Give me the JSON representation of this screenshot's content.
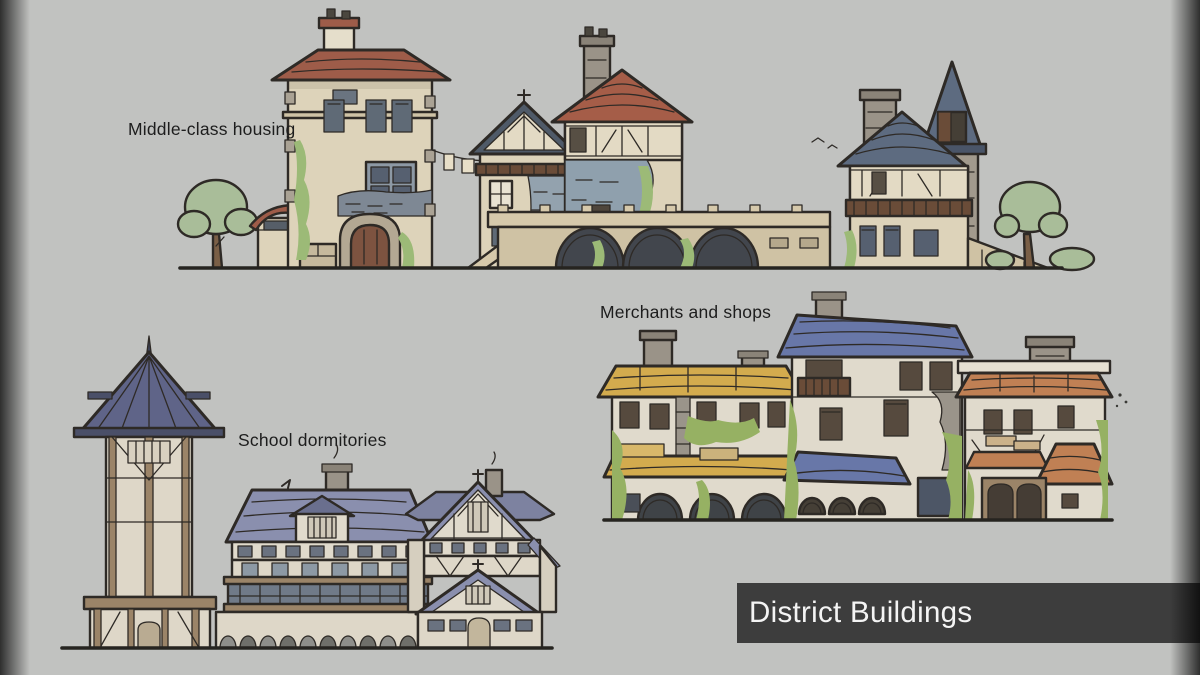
{
  "canvas": {
    "width": 1200,
    "height": 675,
    "background": "#c1c2c0"
  },
  "labels": {
    "middle_class_housing": "Middle-class housing",
    "merchants_and_shops": "Merchants and shops",
    "school_dormitories": "School dormitories"
  },
  "title_card": {
    "text": "District Buildings",
    "background": "#3d3d3d",
    "text_color": "#f4f4f4"
  },
  "palette": {
    "outline": "#2e2a26",
    "wall_cream": "#ddd3ba",
    "wall_light": "#e0dacc",
    "roof_red": "#9e5c49",
    "roof_slate": "#5d6b80",
    "roof_periwinkle": "#6877a8",
    "roof_lavender": "#8a8fae",
    "roof_yellow": "#d3ab4e",
    "roof_orange": "#c08054",
    "stone_blue": "#8fa0ad",
    "stone_gray": "#9a948a",
    "timber_brown": "#6f5640",
    "timber_tan": "#9b8468",
    "wood_balcony": "#6a4c38",
    "foliage_bright": "#96b163",
    "foliage_muted": "#a9bd99",
    "vignette": "#050505"
  },
  "clusters": [
    {
      "name": "middle-class-housing",
      "label_key": "middle_class_housing"
    },
    {
      "name": "school-dormitories",
      "label_key": "school_dormitories"
    },
    {
      "name": "merchants-and-shops",
      "label_key": "merchants_and_shops"
    }
  ]
}
